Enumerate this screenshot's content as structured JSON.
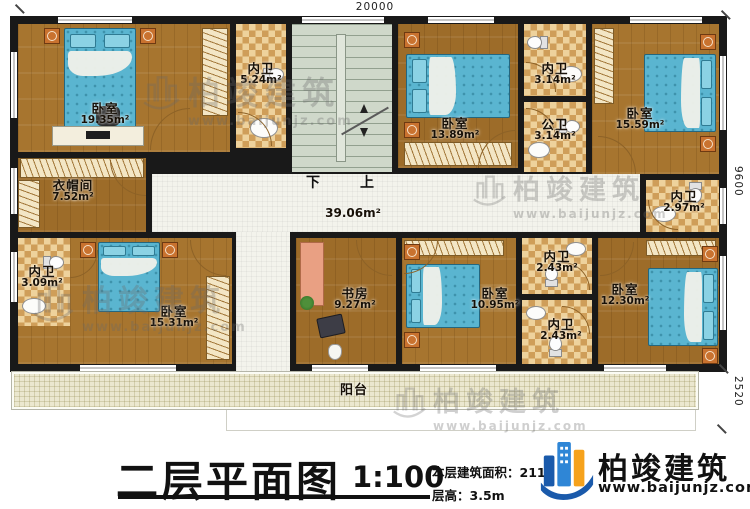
{
  "dimensions": {
    "width_top": "20000",
    "height_right": "9600",
    "balcony_right": "2520"
  },
  "stairs": {
    "down": "下",
    "up": "上"
  },
  "corridor": {
    "area": "39.06m²"
  },
  "balcony": {
    "label": "阳台"
  },
  "rooms": [
    {
      "label": "卧室",
      "area": "19.35m²"
    },
    {
      "label": "内卫",
      "area": "5.24m²"
    },
    {
      "label": "卧室",
      "area": "13.89m²"
    },
    {
      "label": "内卫",
      "area": "3.14m²"
    },
    {
      "label": "公卫",
      "area": "3.14m²"
    },
    {
      "label": "卧室",
      "area": "15.59m²"
    },
    {
      "label": "衣帽间",
      "area": "7.52m²"
    },
    {
      "label": "内卫",
      "area": "2.97m²"
    },
    {
      "label": "内卫",
      "area": "3.09m²"
    },
    {
      "label": "卧室",
      "area": "15.31m²"
    },
    {
      "label": "书房",
      "area": "9.27m²"
    },
    {
      "label": "卧室",
      "area": "10.95m²"
    },
    {
      "label": "内卫",
      "area": "2.43m²"
    },
    {
      "label": "内卫",
      "area": "2.43m²"
    },
    {
      "label": "卧室",
      "area": "12.30m²"
    }
  ],
  "title_block": {
    "title": "二层平面图",
    "scale": "1:100",
    "area_line": "本层建筑面积：211.",
    "floor_height_line": "层高：3.5m"
  },
  "logo": {
    "brand": "柏竣建筑",
    "website": "www.baijunjz.com"
  },
  "watermark": {
    "brand": "柏竣建筑",
    "website": "www.baijunjz.com"
  }
}
